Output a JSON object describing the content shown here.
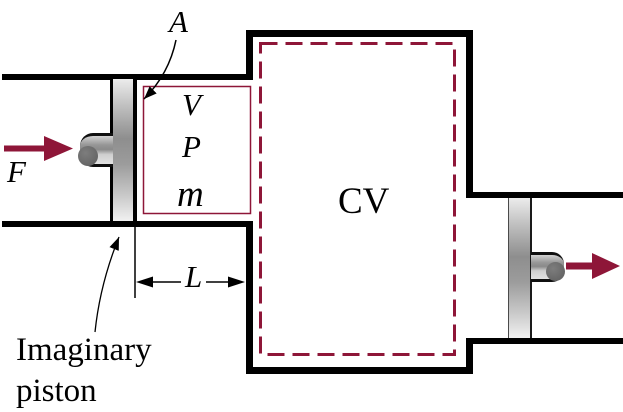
{
  "diagram": {
    "labels": {
      "area": "A",
      "force": "F",
      "volume": "V",
      "pressure": "P",
      "mass": "m",
      "control_volume": "CV",
      "length": "L",
      "imaginary_piston": "Imaginary\npiston"
    },
    "colors": {
      "accent_maroon": "#8e1638",
      "wall_black": "#000000",
      "background": "#ffffff"
    }
  }
}
